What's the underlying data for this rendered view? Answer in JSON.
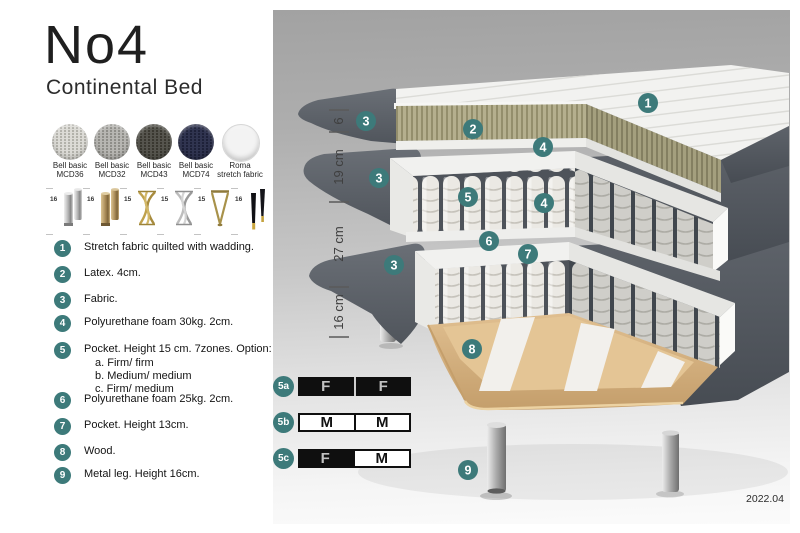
{
  "header": {
    "title": "No4",
    "subtitle": "Continental Bed"
  },
  "swatches": [
    {
      "line1": "Bell basic",
      "line2": "MCD36",
      "color": "#dcdbd6"
    },
    {
      "line1": "Bell basic",
      "line2": "MCD32",
      "color": "#b7b6b2"
    },
    {
      "line1": "Bell basic",
      "line2": "MCD43",
      "color": "#56554e"
    },
    {
      "line1": "Bell basic",
      "line2": "MCD74",
      "color": "#303450"
    },
    {
      "line1": "Roma",
      "line2": "stretch fabric",
      "color": "#f3f3f3"
    }
  ],
  "legs": [
    {
      "height": "16",
      "style": "cylinder-silver"
    },
    {
      "height": "16",
      "style": "cylinder-brass"
    },
    {
      "height": "15",
      "style": "twist-gold"
    },
    {
      "height": "15",
      "style": "twist-silver"
    },
    {
      "height": "15",
      "style": "hairpin-gold"
    },
    {
      "height": "16",
      "style": "taper-black-gold"
    }
  ],
  "legend": {
    "items": [
      {
        "num": "1",
        "text": "Stretch fabric quilted with wadding."
      },
      {
        "num": "2",
        "text": "Latex. 4cm."
      },
      {
        "num": "3",
        "text": "Fabric."
      },
      {
        "num": "4",
        "text": "Polyurethane foam 30kg. 2cm."
      },
      {
        "num": "5",
        "text": "Pocket. Height 15 cm. 7zones. Option:",
        "option_a": "a. Firm/ firm",
        "option_b": "b. Medium/ medium",
        "option_c": "c. Firm/ medium"
      },
      {
        "num": "6",
        "text": "Polyurethane foam 25kg. 2cm."
      },
      {
        "num": "7",
        "text": "Pocket. Height 13cm."
      },
      {
        "num": "8",
        "text": "Wood."
      },
      {
        "num": "9",
        "text": "Metal leg. Height 16cm."
      }
    ]
  },
  "illustration": {
    "callouts": {
      "c1": "1",
      "c2": "2",
      "c3a": "3",
      "c3b": "3",
      "c3c": "3",
      "c4a": "4",
      "c4b": "4",
      "c5": "5",
      "c6": "6",
      "c7": "7",
      "c8": "8",
      "c9": "9"
    },
    "dimensions": {
      "d1": "6",
      "d2": "19 cm",
      "d3": "27 cm",
      "d4": "16 cm"
    },
    "version": "2022.04"
  },
  "firmness": {
    "rows": [
      {
        "badge": "5a",
        "left": "F",
        "right": "F"
      },
      {
        "badge": "5b",
        "left": "M",
        "right": "M"
      },
      {
        "badge": "5c",
        "left": "F",
        "right": "M"
      }
    ]
  },
  "colors": {
    "accent_teal": "#3D7A7A",
    "fabric_dark": "#575c63",
    "latex_khaki": "#b4af8e",
    "wood": "#d9b787"
  }
}
